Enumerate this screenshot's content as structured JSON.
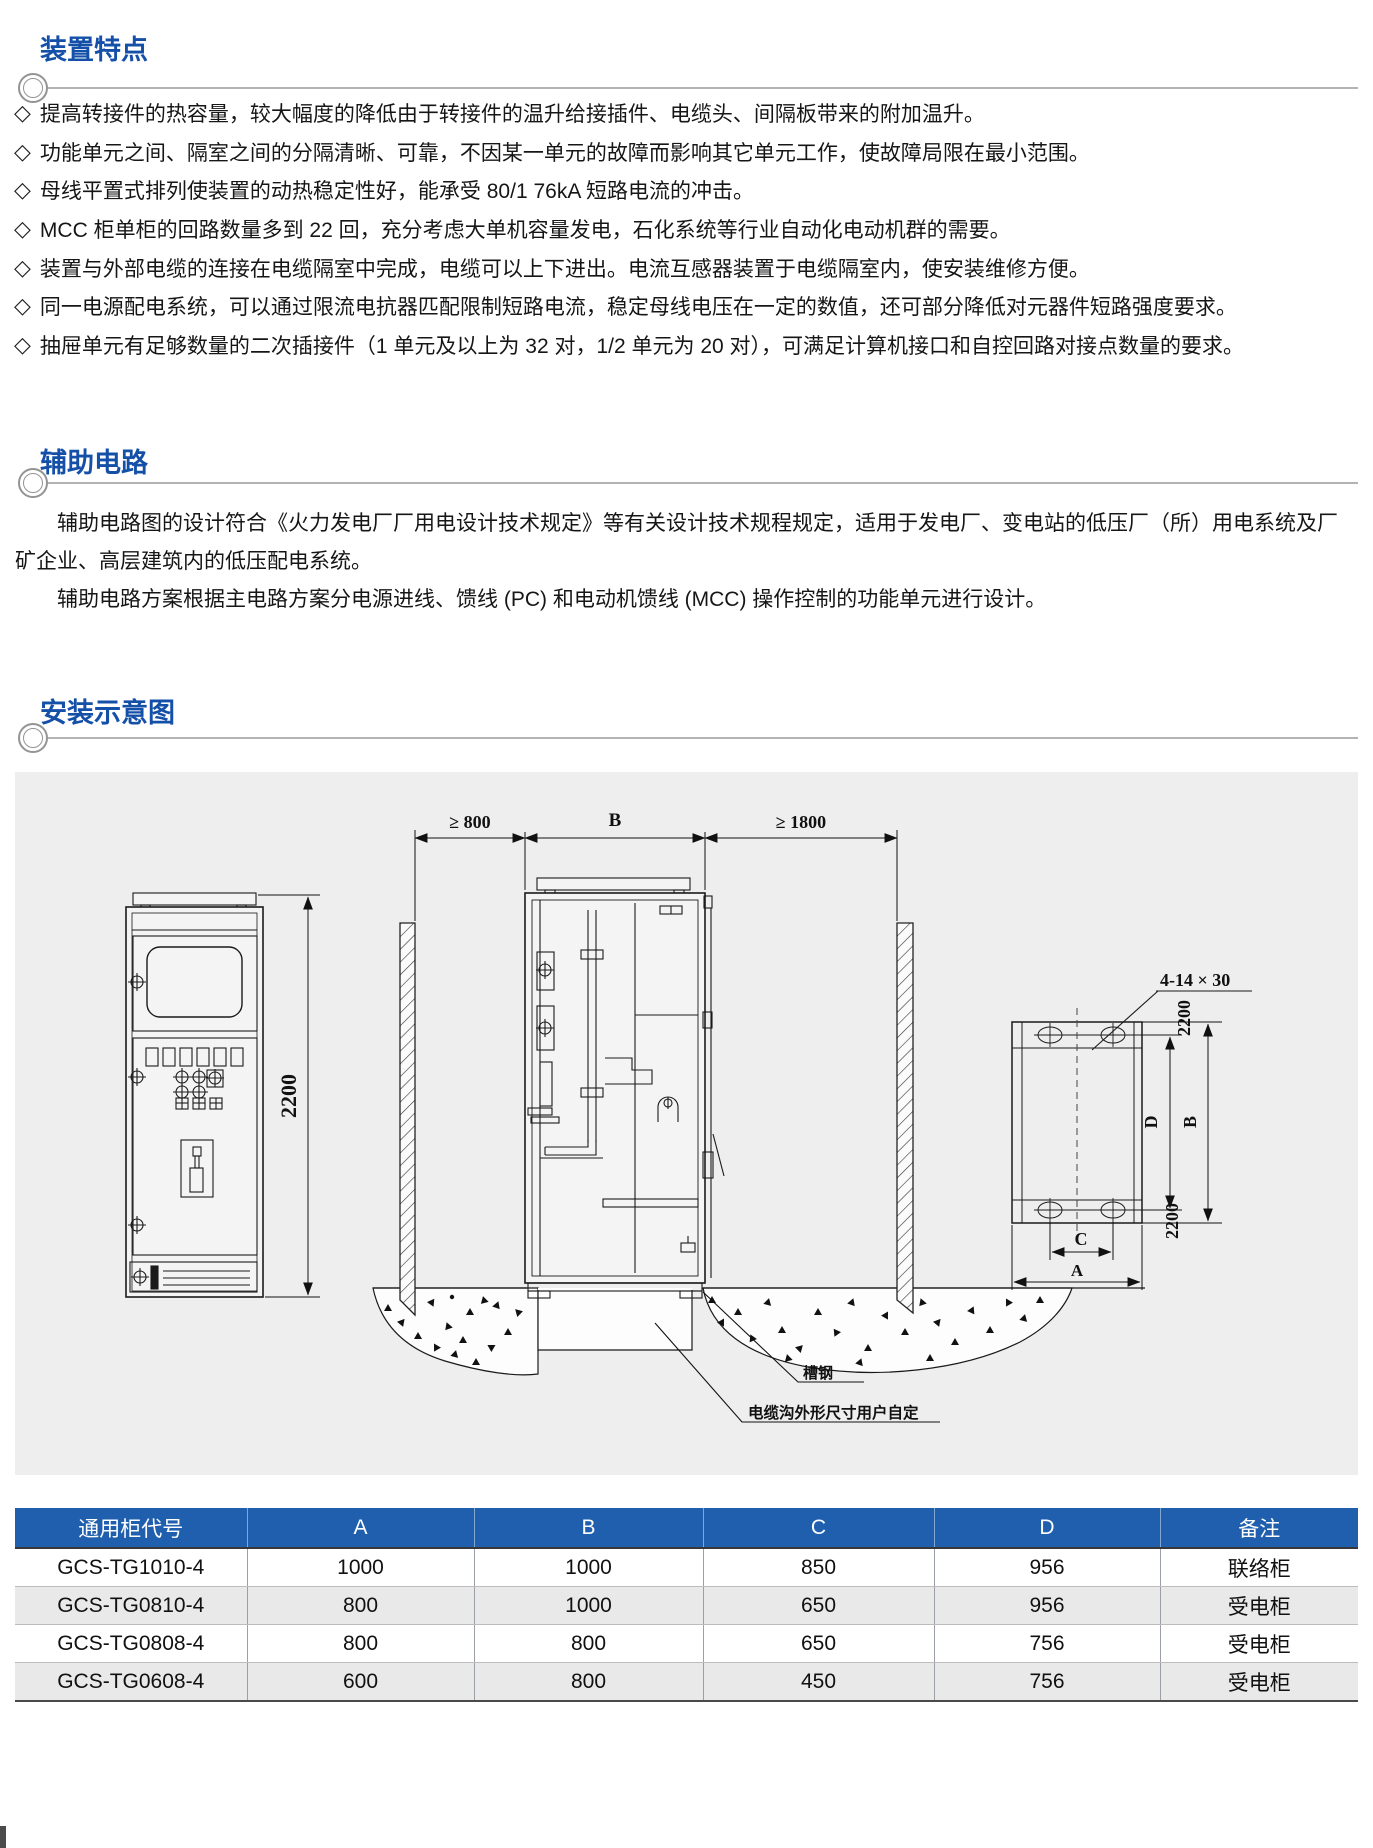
{
  "glyphs": {
    "bullet": "◇"
  },
  "colors": {
    "section_title_blue": "#1550a8",
    "table_header_blue": "#1f5fae",
    "panel_gray": "#eeeeef",
    "rule_gray": "#b3b3b3"
  },
  "sections": {
    "features": {
      "title": "装置特点",
      "items": [
        "提高转接件的热容量，较大幅度的降低由于转接件的温升给接插件、电缆头、间隔板带来的附加温升。",
        "功能单元之间、隔室之间的分隔清晰、可靠，不因某一单元的故障而影响其它单元工作，使故障局限在最小范围。",
        "母线平置式排列使装置的动热稳定性好，能承受 80/1 76kA 短路电流的冲击。",
        "MCC 柜单柜的回路数量多到 22 回，充分考虑大单机容量发电，石化系统等行业自动化电动机群的需要。",
        "装置与外部电缆的连接在电缆隔室中完成，电缆可以上下进出。电流互感器装置于电缆隔室内，使安装维修方便。",
        "同一电源配电系统，可以通过限流电抗器匹配限制短路电流，稳定母线电压在一定的数值，还可部分降低对元器件短路强度要求。",
        "抽屉单元有足够数量的二次插接件（1 单元及以上为 32 对，1/2 单元为 20 对），可满足计算机接口和自控回路对接点数量的要求。"
      ]
    },
    "auxiliary": {
      "title": "辅助电路",
      "paragraphs": [
        "辅助电路图的设计符合《火力发电厂厂用电设计技术规定》等有关设计技术规程规定，适用于发电厂、变电站的低压厂（所）用电系统及厂矿企业、高层建筑内的低压配电系统。",
        "辅助电路方案根据主电路方案分电源进线、馈线 (PC) 和电动机馈线 (MCC) 操作控制的功能单元进行设计。"
      ]
    },
    "installation": {
      "title": "安装示意图"
    }
  },
  "diagram": {
    "front_view": {
      "height_dim": "2200"
    },
    "side_view": {
      "left_clearance": "≥ 800",
      "cabinet_depth": "B",
      "right_clearance": "≥ 1800",
      "channel_steel_label": "槽钢",
      "cable_trench_label": "电缆沟外形尺寸用户自定"
    },
    "plan_view": {
      "slot_spec": "4-14 × 30",
      "top_height": "2200",
      "dim_d": "D",
      "dim_b": "B",
      "bottom_height": "2200",
      "dim_c": "C",
      "dim_a": "A"
    }
  },
  "table": {
    "headers": [
      "通用柜代号",
      "A",
      "B",
      "C",
      "D",
      "备注"
    ],
    "rows": [
      [
        "GCS-TG1010-4",
        "1000",
        "1000",
        "850",
        "956",
        "联络柜"
      ],
      [
        "GCS-TG0810-4",
        "800",
        "1000",
        "650",
        "956",
        "受电柜"
      ],
      [
        "GCS-TG0808-4",
        "800",
        "800",
        "650",
        "756",
        "受电柜"
      ],
      [
        "GCS-TG0608-4",
        "600",
        "800",
        "450",
        "756",
        "受电柜"
      ]
    ]
  }
}
